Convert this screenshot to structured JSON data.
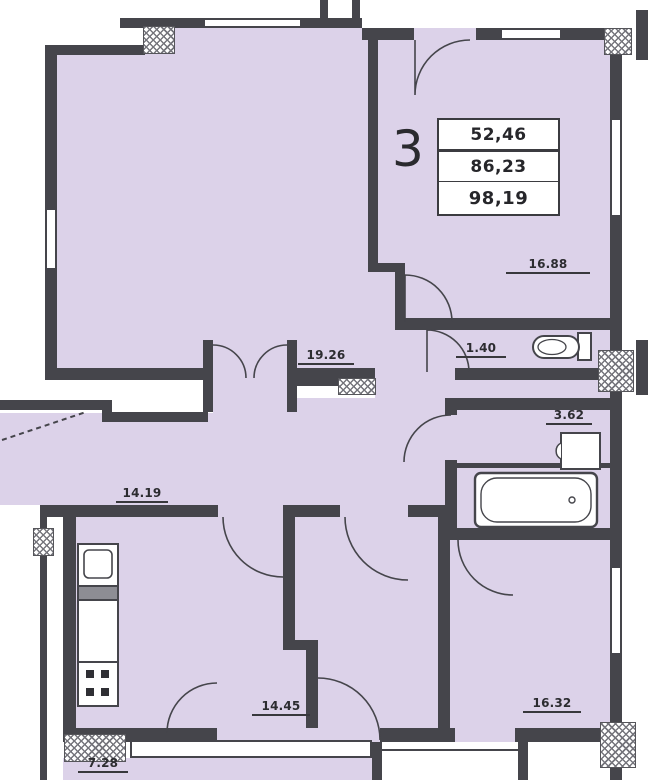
{
  "plan": {
    "unit_number": "3",
    "info_box": {
      "rows": [
        "52,46",
        "86,23",
        "98,19"
      ]
    },
    "rooms": [
      {
        "name": "bedroom-top-right",
        "area": "16.88"
      },
      {
        "name": "living-room",
        "area": "19.26"
      },
      {
        "name": "wc",
        "area": "1.40"
      },
      {
        "name": "bathroom",
        "area": "3.62"
      },
      {
        "name": "hall",
        "area": "14.19"
      },
      {
        "name": "bedroom-bottom-middle",
        "area": "14.45"
      },
      {
        "name": "bedroom-bottom-right",
        "area": "16.32"
      },
      {
        "name": "balcony",
        "area": "7.28"
      }
    ],
    "fixtures": [
      "toilet-icon",
      "washbasin-icon",
      "bathtub-icon",
      "kitchen-sink-icon",
      "stove-icon"
    ],
    "colors": {
      "room_fill": "#dcd2e9",
      "wall": "#45454b"
    }
  }
}
